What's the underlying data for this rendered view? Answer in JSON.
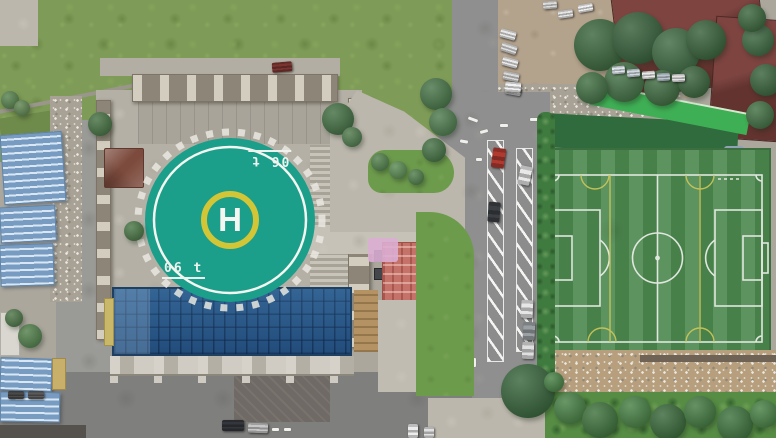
{
  "scene": {
    "description": "Aerial drone view: rooftop helipad building with glass atrium, parking road and artificial-turf soccer field",
    "helipad": {
      "letter": "H",
      "weight_marking": "06 t",
      "weight_marking_rotated_copy": "06 t",
      "surface_color": "#1b9e8a",
      "outer_ring_color": "#f2f5f0",
      "center_ring_color": "#d2c636"
    },
    "soccer_field": {
      "turf_color": "#4e8a50",
      "main_line_color": "#e8ece6",
      "secondary_line_color": "#cfc75a"
    },
    "colors": {
      "glass_roof": "#2a5a8c",
      "shed_roof_blue": "#8fb4d6",
      "grass": "#7e9c57",
      "asphalt": "#8e8f8e",
      "maroon_roof": "#6e3a36",
      "lawn": "#6d9b4c",
      "dirt_lot": "#b3a28c"
    },
    "sheds": [
      {
        "x": 2,
        "y": 133,
        "w": 62,
        "h": 70,
        "r": -4
      },
      {
        "x": 0,
        "y": 206,
        "w": 56,
        "h": 36,
        "r": -3
      },
      {
        "x": 0,
        "y": 244,
        "w": 54,
        "h": 42,
        "r": -2
      },
      {
        "x": 0,
        "y": 358,
        "w": 52,
        "h": 33,
        "r": 2
      },
      {
        "x": 0,
        "y": 392,
        "w": 60,
        "h": 30,
        "r": 1
      }
    ],
    "trees": [
      {
        "cx": 100,
        "cy": 124,
        "r": 12,
        "c": "#3d6b3a"
      },
      {
        "cx": 134,
        "cy": 231,
        "r": 10,
        "c": "#41703d"
      },
      {
        "cx": 338,
        "cy": 119,
        "r": 16,
        "c": "#3a683a"
      },
      {
        "cx": 352,
        "cy": 137,
        "r": 10,
        "c": "#477444"
      },
      {
        "cx": 600,
        "cy": 45,
        "r": 26,
        "c": "#315f33"
      },
      {
        "cx": 638,
        "cy": 38,
        "r": 26,
        "c": "#2c5830"
      },
      {
        "cx": 676,
        "cy": 52,
        "r": 24,
        "c": "#35633a"
      },
      {
        "cx": 706,
        "cy": 40,
        "r": 20,
        "c": "#2e5a31"
      },
      {
        "cx": 624,
        "cy": 82,
        "r": 20,
        "c": "#3a6a3c"
      },
      {
        "cx": 662,
        "cy": 88,
        "r": 18,
        "c": "#356336"
      },
      {
        "cx": 694,
        "cy": 82,
        "r": 16,
        "c": "#305c33"
      },
      {
        "cx": 592,
        "cy": 88,
        "r": 16,
        "c": "#386839"
      },
      {
        "cx": 758,
        "cy": 40,
        "r": 16,
        "c": "#35633a"
      },
      {
        "cx": 766,
        "cy": 80,
        "r": 16,
        "c": "#2f5c33"
      },
      {
        "cx": 760,
        "cy": 115,
        "r": 14,
        "c": "#386839"
      },
      {
        "cx": 752,
        "cy": 18,
        "r": 14,
        "c": "#315f33"
      },
      {
        "cx": 436,
        "cy": 94,
        "r": 16,
        "c": "#3f6e3f"
      },
      {
        "cx": 443,
        "cy": 122,
        "r": 14,
        "c": "#457545"
      },
      {
        "cx": 434,
        "cy": 150,
        "r": 12,
        "c": "#3c6b3c"
      },
      {
        "cx": 528,
        "cy": 391,
        "r": 27,
        "c": "#2e5e32"
      },
      {
        "cx": 380,
        "cy": 162,
        "r": 9,
        "c": "#4a7a43"
      },
      {
        "cx": 398,
        "cy": 170,
        "r": 9,
        "c": "#52854a"
      },
      {
        "cx": 416,
        "cy": 177,
        "r": 8,
        "c": "#477741"
      },
      {
        "cx": 30,
        "cy": 336,
        "r": 12,
        "c": "#4a7a43"
      },
      {
        "cx": 14,
        "cy": 318,
        "r": 9,
        "c": "#456f3f"
      },
      {
        "cx": 10,
        "cy": 100,
        "r": 9,
        "c": "#4f7c45"
      },
      {
        "cx": 22,
        "cy": 108,
        "r": 8,
        "c": "#577f48"
      },
      {
        "cx": 570,
        "cy": 408,
        "r": 16,
        "c": "#3f7a3b"
      },
      {
        "cx": 600,
        "cy": 420,
        "r": 18,
        "c": "#356b33"
      },
      {
        "cx": 635,
        "cy": 412,
        "r": 16,
        "c": "#3f7a3b"
      },
      {
        "cx": 668,
        "cy": 422,
        "r": 18,
        "c": "#2f6130"
      },
      {
        "cx": 700,
        "cy": 412,
        "r": 16,
        "c": "#3a7338"
      },
      {
        "cx": 735,
        "cy": 424,
        "r": 18,
        "c": "#346b34"
      },
      {
        "cx": 764,
        "cy": 414,
        "r": 14,
        "c": "#3f7a3b"
      },
      {
        "cx": 554,
        "cy": 382,
        "r": 10,
        "c": "#3f7a3b"
      }
    ],
    "cars": [
      {
        "x": 500,
        "y": 30,
        "w": 16,
        "h": 9,
        "r": 15,
        "c": "#e8e8e8"
      },
      {
        "x": 501,
        "y": 44,
        "w": 16,
        "h": 9,
        "r": 18,
        "c": "#dedede"
      },
      {
        "x": 502,
        "y": 58,
        "w": 16,
        "h": 9,
        "r": 15,
        "c": "#eaeaea"
      },
      {
        "x": 503,
        "y": 72,
        "w": 16,
        "h": 9,
        "r": 12,
        "c": "#d8d8d8"
      },
      {
        "x": 505,
        "y": 86,
        "w": 16,
        "h": 9,
        "r": 10,
        "c": "#cccccc"
      },
      {
        "x": 558,
        "y": 10,
        "w": 15,
        "h": 8,
        "r": -8,
        "c": "#e5e5e5"
      },
      {
        "x": 578,
        "y": 4,
        "w": 15,
        "h": 8,
        "r": -10,
        "c": "#efefef"
      },
      {
        "x": 543,
        "y": 1,
        "w": 14,
        "h": 8,
        "r": -5,
        "c": "#dcdcdc"
      },
      {
        "x": 612,
        "y": 66,
        "w": 13,
        "h": 8,
        "r": -5,
        "c": "#dde4ea"
      },
      {
        "x": 627,
        "y": 69,
        "w": 13,
        "h": 8,
        "r": -5,
        "c": "#cfd8df"
      },
      {
        "x": 642,
        "y": 71,
        "w": 13,
        "h": 8,
        "r": -4,
        "c": "#e8e8e8"
      },
      {
        "x": 657,
        "y": 73,
        "w": 13,
        "h": 8,
        "r": -3,
        "c": "#b9c4cc"
      },
      {
        "x": 672,
        "y": 74,
        "w": 13,
        "h": 8,
        "r": -2,
        "c": "#e2e2e2"
      },
      {
        "x": 505,
        "y": 82,
        "w": 16,
        "h": 10,
        "r": 5,
        "c": "#f2f2f2"
      },
      {
        "x": 492,
        "y": 148,
        "w": 13,
        "h": 20,
        "r": 8,
        "c": "#b03a30"
      },
      {
        "x": 488,
        "y": 202,
        "w": 12,
        "h": 20,
        "r": 5,
        "c": "#3c3f44"
      },
      {
        "x": 519,
        "y": 166,
        "w": 12,
        "h": 19,
        "r": 12,
        "c": "#e8e8e8"
      },
      {
        "x": 521,
        "y": 300,
        "w": 12,
        "h": 18,
        "r": 3,
        "c": "#e6e6e6"
      },
      {
        "x": 523,
        "y": 322,
        "w": 12,
        "h": 18,
        "r": 3,
        "c": "#9aa0a4"
      },
      {
        "x": 522,
        "y": 342,
        "w": 12,
        "h": 17,
        "r": 2,
        "c": "#dfdfdf"
      },
      {
        "x": 222,
        "y": 420,
        "w": 22,
        "h": 11,
        "r": 0,
        "c": "#33363a"
      },
      {
        "x": 248,
        "y": 423,
        "w": 20,
        "h": 10,
        "r": 2,
        "c": "#c7c7c7"
      },
      {
        "x": 408,
        "y": 424,
        "w": 10,
        "h": 14,
        "r": 0,
        "c": "#ececec"
      },
      {
        "x": 424,
        "y": 427,
        "w": 10,
        "h": 11,
        "r": 0,
        "c": "#e0e0e0"
      },
      {
        "x": 8,
        "y": 391,
        "w": 16,
        "h": 8,
        "r": 0,
        "c": "#4a4a4a"
      },
      {
        "x": 28,
        "y": 391,
        "w": 16,
        "h": 8,
        "r": 0,
        "c": "#5a5a5a"
      },
      {
        "x": 272,
        "y": 62,
        "w": 20,
        "h": 10,
        "r": -5,
        "c": "#7a3530"
      }
    ],
    "road_marks": [
      {
        "x": 468,
        "y": 118,
        "w": 10,
        "h": 3,
        "r": 20
      },
      {
        "x": 480,
        "y": 130,
        "w": 8,
        "h": 3,
        "r": -15
      },
      {
        "x": 500,
        "y": 124,
        "w": 8,
        "h": 3,
        "r": 0
      },
      {
        "x": 460,
        "y": 140,
        "w": 8,
        "h": 3,
        "r": 10
      },
      {
        "x": 530,
        "y": 118,
        "w": 8,
        "h": 3,
        "r": 0
      },
      {
        "x": 476,
        "y": 158,
        "w": 6,
        "h": 3,
        "r": 0
      },
      {
        "x": 453,
        "y": 170,
        "w": 3,
        "h": 9,
        "r": 0
      },
      {
        "x": 453,
        "y": 210,
        "w": 3,
        "h": 9,
        "r": 0
      },
      {
        "x": 453,
        "y": 250,
        "w": 3,
        "h": 9,
        "r": 0
      },
      {
        "x": 453,
        "y": 290,
        "w": 3,
        "h": 9,
        "r": 0
      },
      {
        "x": 453,
        "y": 330,
        "w": 3,
        "h": 9,
        "r": 0
      },
      {
        "x": 464,
        "y": 348,
        "w": 4,
        "h": 12,
        "r": 0
      },
      {
        "x": 472,
        "y": 358,
        "w": 4,
        "h": 9,
        "r": 0
      },
      {
        "x": 272,
        "y": 428,
        "w": 7,
        "h": 3,
        "r": 0
      },
      {
        "x": 284,
        "y": 428,
        "w": 7,
        "h": 3,
        "r": 0
      }
    ]
  }
}
